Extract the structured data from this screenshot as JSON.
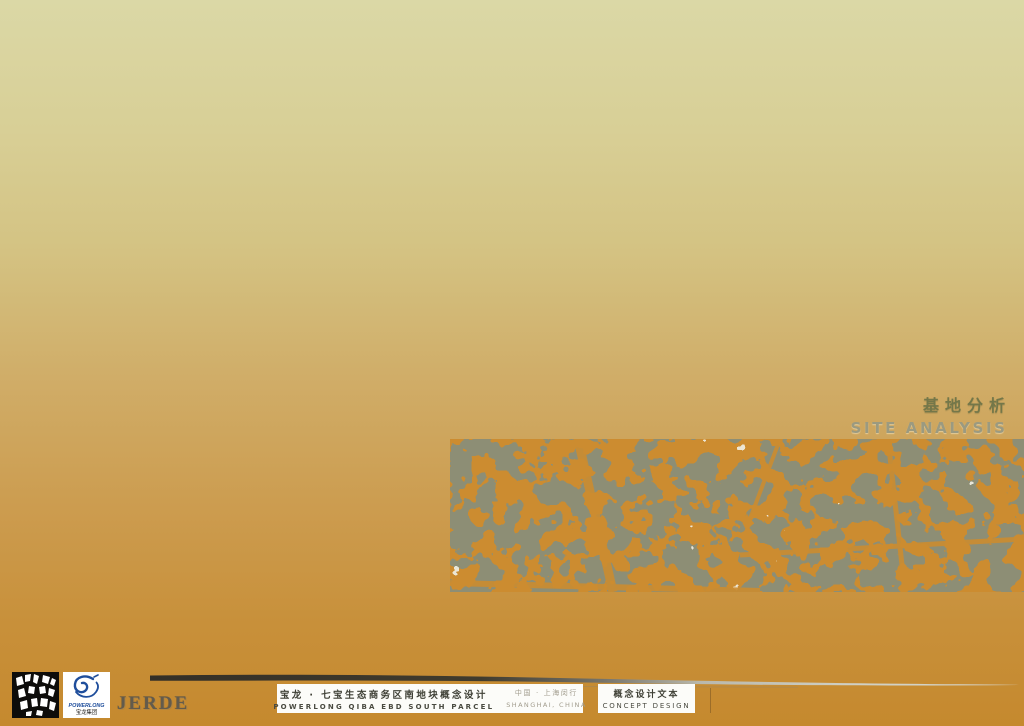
{
  "slide": {
    "section_title_cn": "基地分析",
    "section_title_en": "SITE ANALYSIS"
  },
  "aerial": {
    "description": "duotone-satellite-map-of-site"
  },
  "footer": {
    "logos": {
      "jerde_mosaic_icon": "jerde-mosaic-logo",
      "powerlong": {
        "wordmark": "POWERLONG",
        "cn": "宝龙集团"
      },
      "jerde_wordmark": "JERDE"
    },
    "project": {
      "title_cn": "宝龙 · 七宝生态商务区南地块概念设计",
      "title_en": "POWERLONG QIBA EBD SOUTH PARCEL",
      "location_cn": "中国 · 上海闵行",
      "location_en": "SHANGHAI, CHINA"
    },
    "document": {
      "label_cn": "概念设计文本",
      "label_en": "CONCEPT DESIGN"
    }
  },
  "colors": {
    "bg_top": "#dbd8a6",
    "bg_mid": "#d0ad68",
    "bg_bottom": "#c5892e",
    "title_cn": "#747749",
    "title_en": "#9b9a80",
    "map_ground": "#cc8c30",
    "map_blocks": "#8d8e74",
    "map_highlight": "#efeee2",
    "powerlong_blue": "#1f4e9c",
    "info_text_dark": "#3f4036",
    "info_text_gray": "#a29d8e"
  }
}
